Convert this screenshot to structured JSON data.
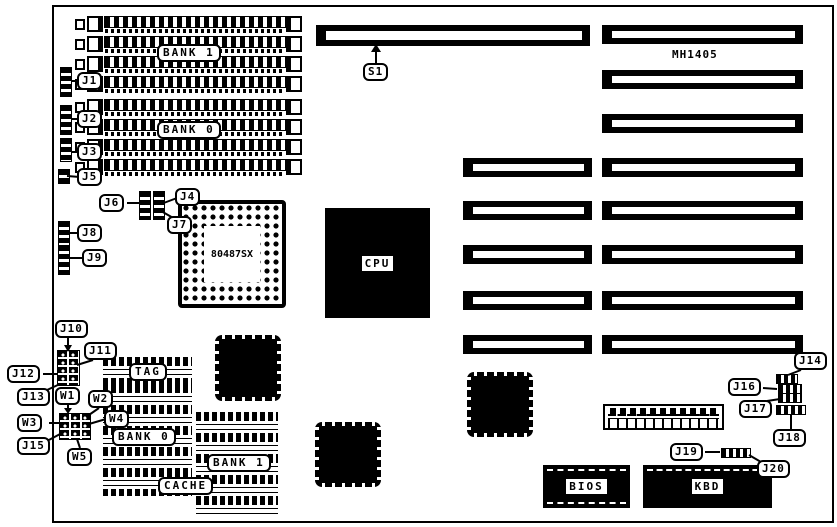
{
  "diagram": {
    "part_number": "MH1405",
    "cpu": "CPU",
    "coprocessor": "80487SX",
    "bios": "BIOS",
    "keyboard_controller": "KBD",
    "tag": "TAG",
    "cache": "CACHE",
    "simm_bank_1": "BANK 1",
    "simm_bank_0": "BANK 0",
    "cache_bank_0": "BANK 0",
    "cache_bank_1": "BANK 1"
  },
  "callouts": {
    "s1": "S1",
    "j1": "J1",
    "j2": "J2",
    "j3": "J3",
    "j4": "J4",
    "j5": "J5",
    "j6": "J6",
    "j7": "J7",
    "j8": "J8",
    "j9": "J9",
    "j10": "J10",
    "j11": "J11",
    "j12": "J12",
    "j13": "J13",
    "j14": "J14",
    "j15": "J15",
    "j16": "J16",
    "j17": "J17",
    "j18": "J18",
    "j19": "J19",
    "j20": "J20",
    "w1": "W1",
    "w2": "W2",
    "w3": "W3",
    "w4": "W4",
    "w5": "W5"
  }
}
